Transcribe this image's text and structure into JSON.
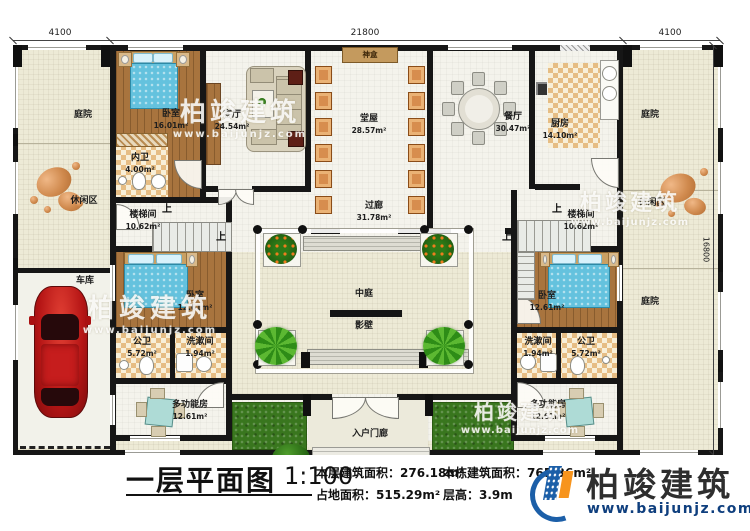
{
  "dimensions": {
    "top_left": "4100",
    "top_center": "21800",
    "top_right": "4100",
    "right_side": "16800"
  },
  "rooms": {
    "courtyard_tl": {
      "name": "庭院"
    },
    "leisure_left": {
      "name": "休闲区"
    },
    "garage": {
      "name": "车库"
    },
    "bedroom1": {
      "name": "卧室",
      "area": "16.01m²"
    },
    "inner_bath": {
      "name": "内卫",
      "area": "4.00m²"
    },
    "living": {
      "name": "客厅",
      "area": "24.54m²"
    },
    "hall": {
      "name": "堂屋",
      "area": "28.57m²"
    },
    "shrine": {
      "name": "神盒"
    },
    "dining": {
      "name": "餐厅",
      "area": "30.47m²"
    },
    "kitchen": {
      "name": "厨房",
      "area": "14.10m²"
    },
    "courtyard_tr": {
      "name": "庭院"
    },
    "leisure_right": {
      "name": "休闲区"
    },
    "courtyard_br": {
      "name": "庭院"
    },
    "stair_left": {
      "name": "楼梯间",
      "area": "10.62m²"
    },
    "stair_right": {
      "name": "楼梯间",
      "area": "10.62m²"
    },
    "corridor": {
      "name": "过廊",
      "area": "31.78m²"
    },
    "atrium": {
      "name": "中庭"
    },
    "screen_wall": {
      "name": "影壁"
    },
    "bedroom2": {
      "name": "卧室",
      "area": "12.61m²"
    },
    "bath_left": {
      "name": "公卫",
      "area": "5.72m²"
    },
    "wash_left": {
      "name": "洗漱间",
      "area": "1.94m²"
    },
    "multi_left": {
      "name": "多功能房",
      "area": "12.61m²"
    },
    "bedroom3": {
      "name": "卧室",
      "area": "12.61m²"
    },
    "wash_right": {
      "name": "洗漱间",
      "area": "1.94m²"
    },
    "bath_right": {
      "name": "公卫",
      "area": "5.72m²"
    },
    "multi_right": {
      "name": "多功能房",
      "area": "12.61m²"
    },
    "porch": {
      "name": "入户门廊"
    },
    "up_label": "上"
  },
  "footer": {
    "plan_title": "一层平面图",
    "scale": "1:100",
    "stats": [
      {
        "label": "本层建筑面积：",
        "value": "276.18m²"
      },
      {
        "label": "占地面积：",
        "value": "515.29m²"
      },
      {
        "label": "本栋建筑面积：",
        "value": "765.36m²"
      },
      {
        "label": "层高：",
        "value": "3.9m"
      }
    ],
    "brand": {
      "name": "柏竣建筑",
      "url": "www.baijunjz.com"
    }
  },
  "watermark": {
    "name": "柏竣建筑",
    "url": "www.baijunjz.com"
  },
  "colors": {
    "accent_blue": "#1c5fa8",
    "accent_orange": "#f7941d",
    "wall": "#161616",
    "wood": "#a8743e",
    "bed_blue": "#64c2de",
    "grass": "#39761e",
    "car_red": "#c01818"
  }
}
